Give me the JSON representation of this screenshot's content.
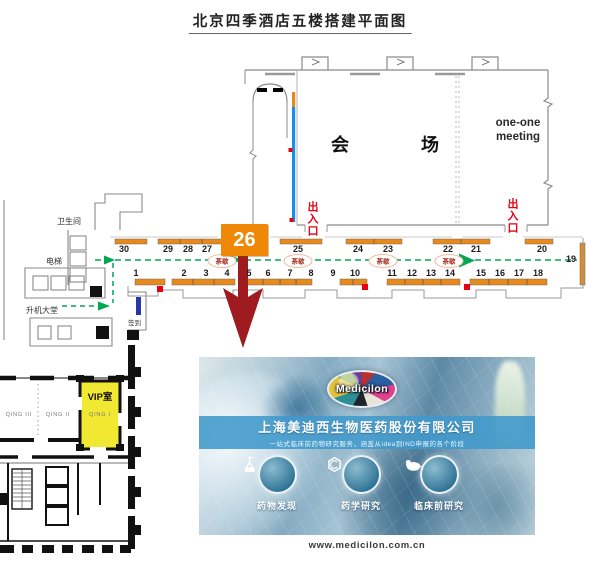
{
  "title": "北京四季酒店五楼搭建平面图",
  "map": {
    "hall": "会场",
    "one_one_meeting": "one-one meeting",
    "entrance": "出入口",
    "tea_break": "茶歇",
    "restroom": "卫生间",
    "elevator": "电梯",
    "lift_lobby": "升机大堂",
    "signin": "签到",
    "featured_booth": "26",
    "top_booths": [
      "30",
      "29",
      "28",
      "27",
      "25",
      "24",
      "23",
      "22",
      "21",
      "20",
      "19"
    ],
    "bottom_booths": [
      "1",
      "2",
      "3",
      "4",
      "5",
      "6",
      "7",
      "8",
      "9",
      "10",
      "11",
      "12",
      "13",
      "14",
      "15",
      "16",
      "17",
      "18"
    ]
  },
  "inset": {
    "vip": "VIP室",
    "qing1": "QING I",
    "qing2": "QING II",
    "qing3": "QING III"
  },
  "banner": {
    "logo": "Medicilon",
    "company": "上海美迪西生物医药股份有限公司",
    "tagline": "一站式临床前药物研究服务，涵盖从idea到IND申报的各个阶段",
    "services": [
      "药物发现",
      "药学研究",
      "临床前研究"
    ],
    "website": "www.medicilon.com.cn"
  },
  "colors": {
    "booth_orange": "#e8891b",
    "highlight_orange": "#ef8807",
    "arrow_red": "#9e1b1f",
    "route_green": "#00a651",
    "entrance_red": "#e60012",
    "vip_yellow": "#f1e832",
    "banner_blue": "#4098cb",
    "stage_blue": "#1b8fe4"
  }
}
